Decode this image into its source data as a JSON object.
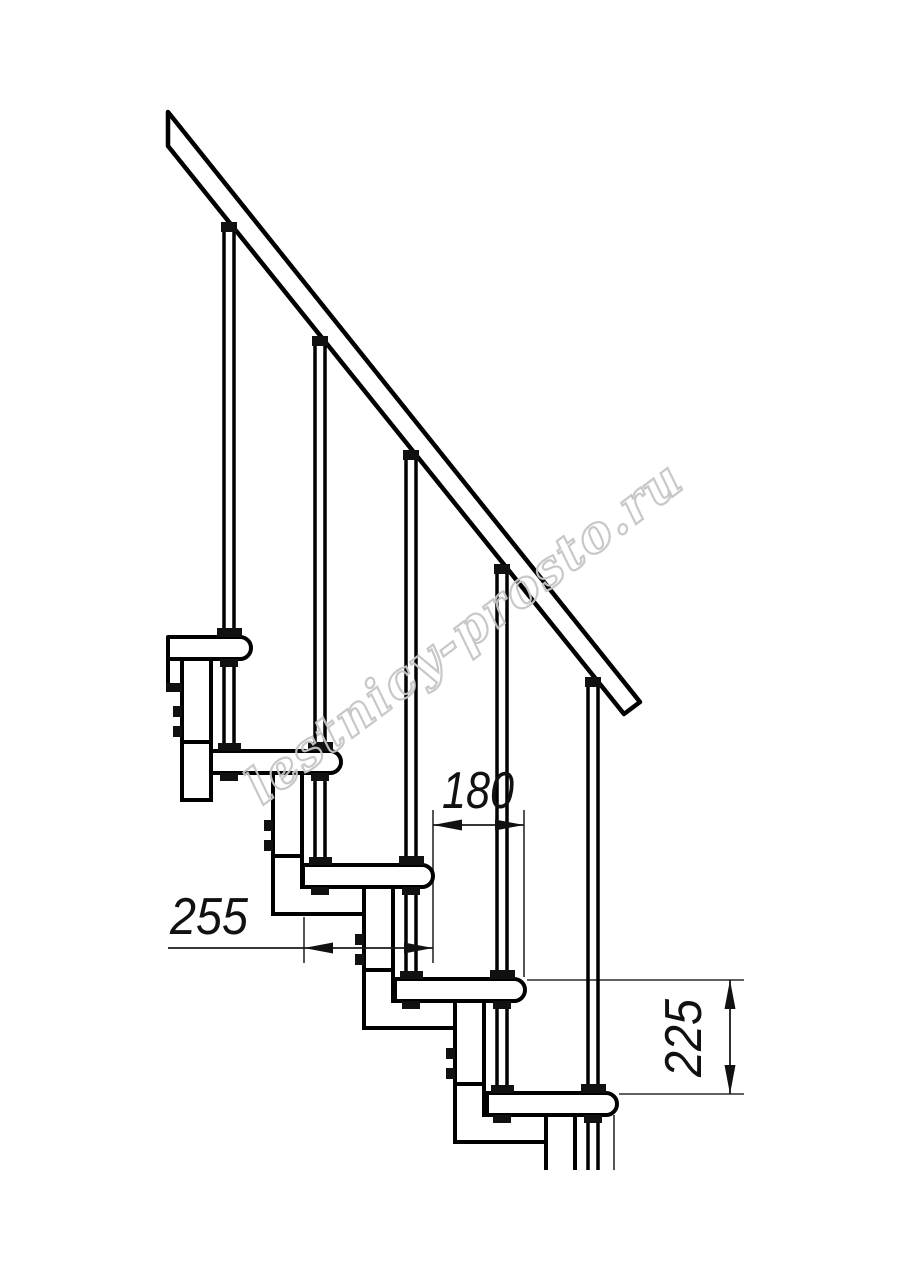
{
  "page": {
    "background": "#ffffff"
  },
  "drawing": {
    "type": "modular-staircase-side-view",
    "line_color": "#000000",
    "thin_line_color": "#2b2b2b",
    "dimensions": [
      {
        "id": "dim-180",
        "label": "180"
      },
      {
        "id": "dim-255",
        "label": "255"
      },
      {
        "id": "dim-225",
        "label": "225"
      }
    ],
    "watermark": {
      "text": "lestnicy-prosto.ru",
      "color": "#c6c6c6"
    }
  }
}
